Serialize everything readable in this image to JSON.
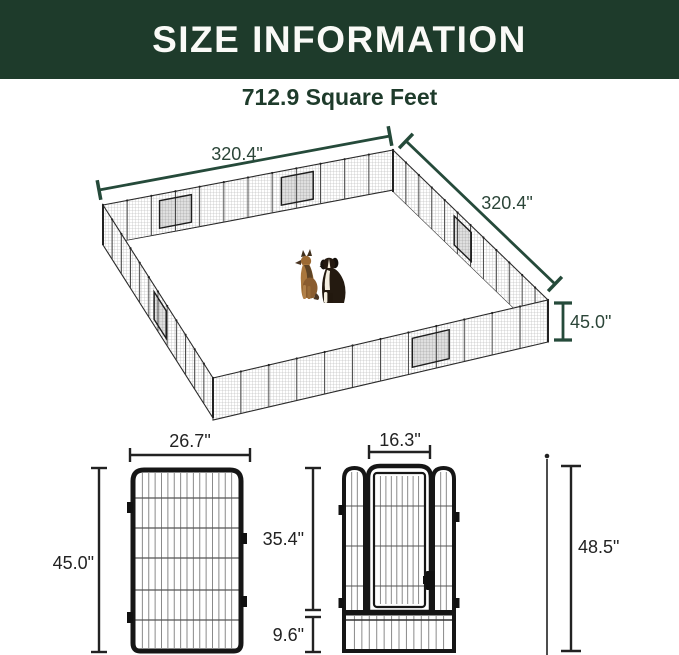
{
  "header": {
    "title": "SIZE INFORMATION"
  },
  "subtitle": "712.9 Square Feet",
  "enclosure": {
    "side_a_label": "320.4\"",
    "side_b_label": "320.4\"",
    "height_label": "45.0\"",
    "dogs": [
      "german-shepherd",
      "bernese-mountain-dog"
    ]
  },
  "single_panel": {
    "width_label": "26.7\"",
    "height_label": "45.0\""
  },
  "door_panel": {
    "door_width_label": "16.3\"",
    "upper_height_label": "35.4\"",
    "bottom_height_label": "9.6\""
  },
  "ground_stake": {
    "height_label": "48.5\""
  },
  "colors": {
    "banner_green": "#1e3b2b",
    "dimension_green": "#254a3a",
    "dimension_dark": "#222222"
  }
}
